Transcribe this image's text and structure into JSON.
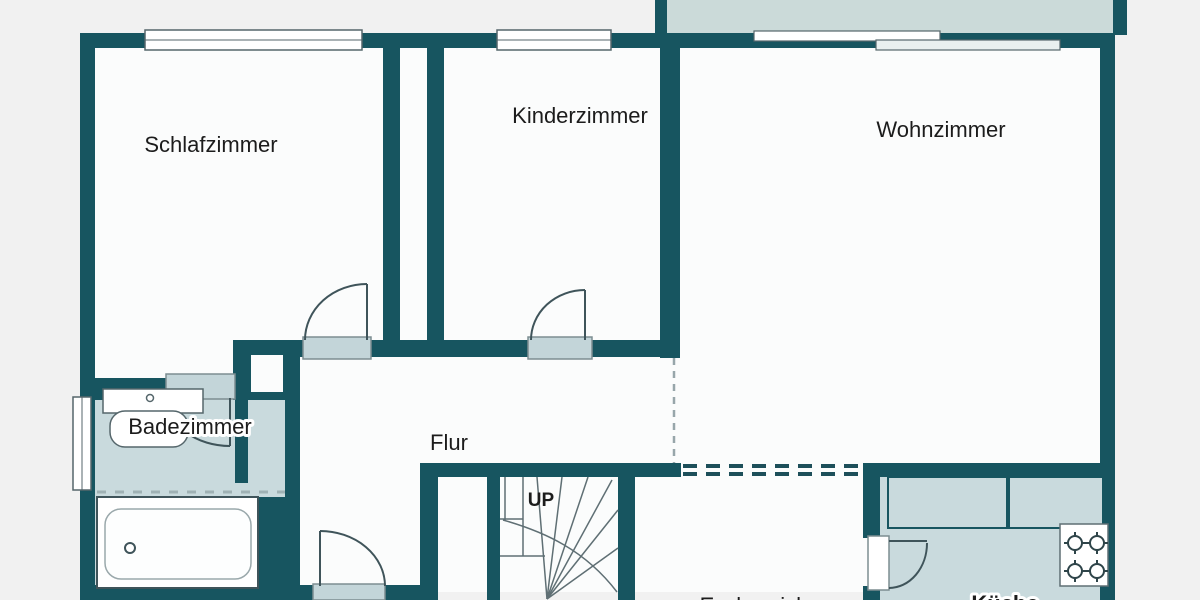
{
  "plan": {
    "type": "floor-plan",
    "language": "de",
    "colors": {
      "wall": "#175560",
      "room_fill": "#c9dadd",
      "balcony_fill": "#cbdad9",
      "floor": "#fbfcfc",
      "background": "#f1f1f1",
      "fixture_outline": "#55666b",
      "open_boundary_dash": "#1d4f5a"
    },
    "rooms": {
      "schlafzimmer": {
        "label": "Schlafzimmer"
      },
      "kinderzimmer": {
        "label": "Kinderzimmer"
      },
      "wohnzimmer": {
        "label": "Wohnzimmer"
      },
      "badezimmer": {
        "label": "Badezimmer"
      },
      "flur": {
        "label": "Flur"
      },
      "essbereich": {
        "label": "Essbereich"
      },
      "kueche": {
        "label": "Küche"
      }
    },
    "stairs": {
      "direction_label": "UP"
    },
    "fixtures": [
      "bathtub",
      "washbasin",
      "stove-4-burners",
      "kitchen-counters",
      "winder-staircase",
      "balcony"
    ]
  }
}
